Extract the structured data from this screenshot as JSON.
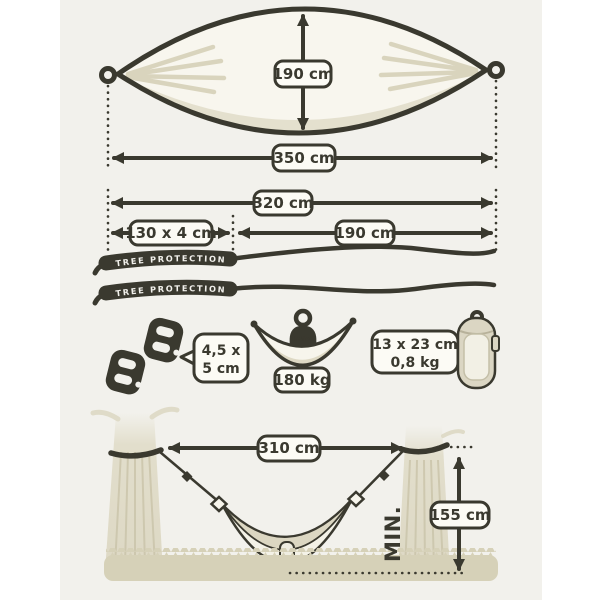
{
  "title": "hammock-dimensions-diagram",
  "colors": {
    "ink": "#3a392f",
    "canvas": "#f2f1ec",
    "label_fill": "#fcfbf5",
    "fabric_cream": "#f7f5ec",
    "shade_beige": "#dcd7c2",
    "ground_tan": "#d6d1b8",
    "trunk": "#ddd8c4"
  },
  "hammock": {
    "width": "190 cm",
    "length": "350 cm"
  },
  "suspension": {
    "total_length": "320 cm",
    "strap_size": "130 x 4 cm",
    "rope_length": "190 cm",
    "strap_text": "TREE PROTECTION"
  },
  "accessories": {
    "carabiner_size_line1": "4,5 x",
    "carabiner_size_line2": "5 cm",
    "max_label": "max.",
    "capacity": "180 kg",
    "pack_size_line1": "13 x 23 cm",
    "pack_size_line2": "0,8 kg"
  },
  "hanging_scene": {
    "distance": "310 cm",
    "height": "155 cm",
    "min_label": "MIN."
  }
}
